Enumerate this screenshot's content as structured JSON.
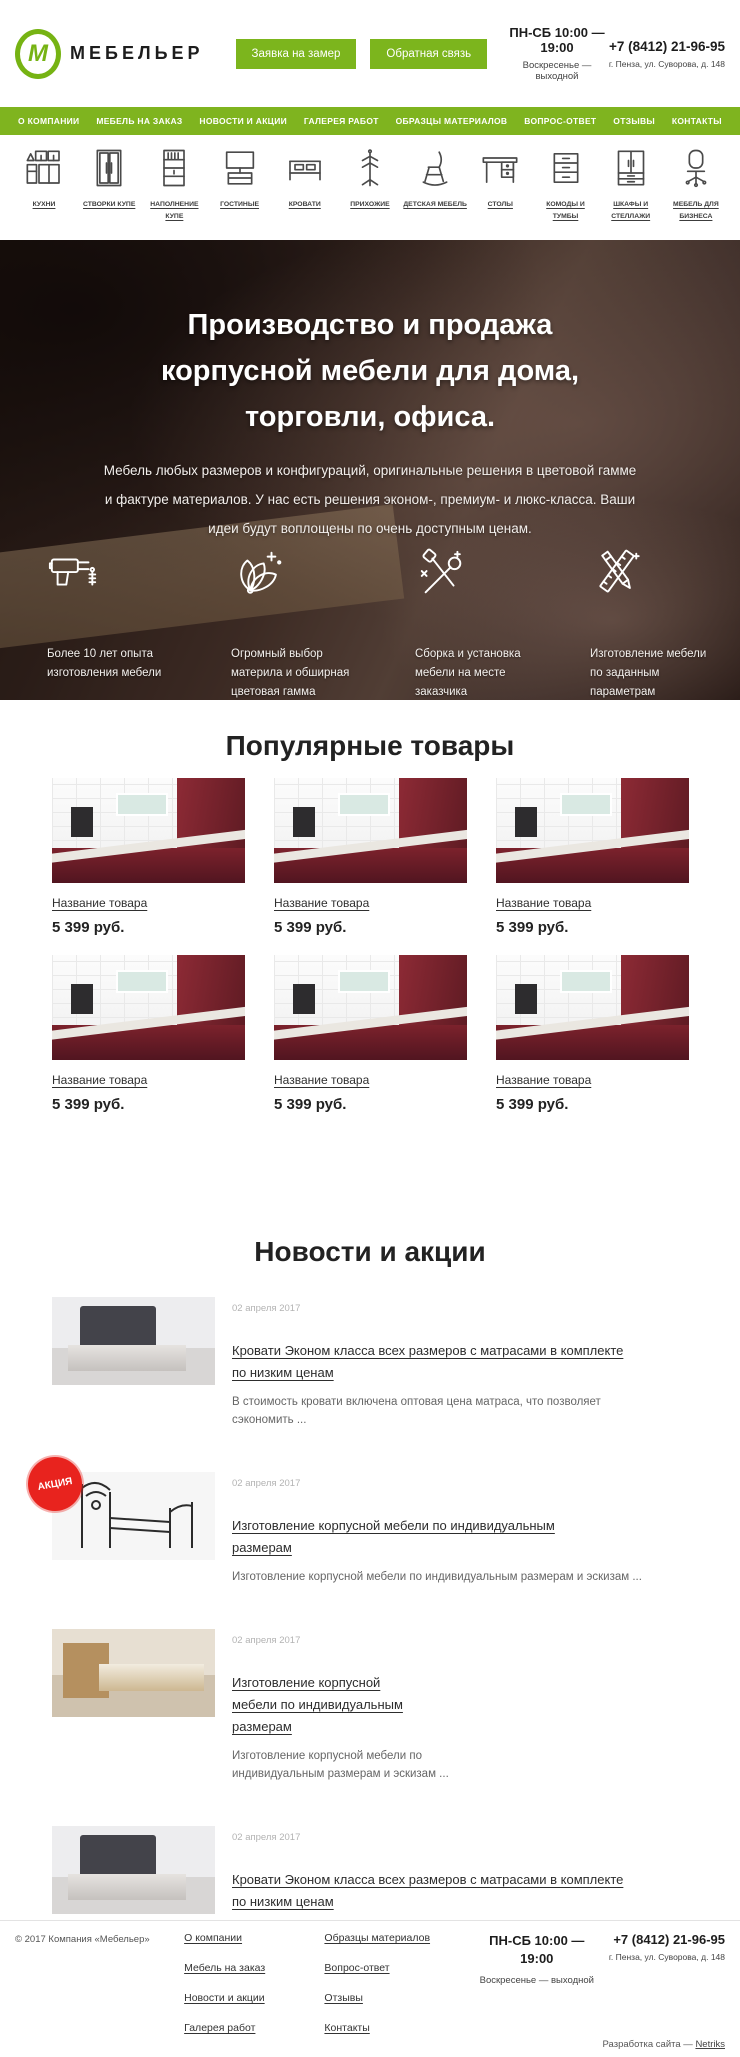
{
  "header": {
    "logo_letter": "М",
    "brand": "МЕБЕЛЬЕР",
    "request_button": "Заявка на замер",
    "feedback_button": "Обратная связь",
    "hours_main": "ПН-СБ 10:00 — 19:00",
    "hours_note": "Воскресенье — выходной",
    "phone": "+7 (8412) 21-96-95",
    "address": "г. Пенза, ул. Суворова, д. 148"
  },
  "nav": {
    "items": [
      "О КОМПАНИИ",
      "МЕБЕЛЬ НА ЗАКАЗ",
      "НОВОСТИ И АКЦИИ",
      "ГАЛЕРЕЯ РАБОТ",
      "ОБРАЗЦЫ МАТЕРИАЛОВ",
      "ВОПРОС-ОТВЕТ",
      "ОТЗЫВЫ",
      "КОНТАКТЫ"
    ]
  },
  "categories": {
    "items": [
      {
        "label": "КУХНИ",
        "icon": "kitchen-icon"
      },
      {
        "label": "СТВОРКИ КУПЕ",
        "icon": "sliding-doors-icon"
      },
      {
        "label": "НАПОЛНЕНИЕ КУПЕ",
        "icon": "shelving-icon"
      },
      {
        "label": "ГОСТИНЫЕ",
        "icon": "tv-stand-icon"
      },
      {
        "label": "КРОВАТИ",
        "icon": "bed-icon"
      },
      {
        "label": "ПРИХОЖИЕ",
        "icon": "coat-rack-icon"
      },
      {
        "label": "ДЕТСКАЯ МЕБЕЛЬ",
        "icon": "kids-chair-icon"
      },
      {
        "label": "СТОЛЫ",
        "icon": "desk-icon"
      },
      {
        "label": "КОМОДЫ И ТУМБЫ",
        "icon": "drawers-icon"
      },
      {
        "label": "ШКАФЫ И СТЕЛЛАЖИ",
        "icon": "wardrobe-icon"
      },
      {
        "label": "МЕБЕЛЬ ДЛЯ БИЗНЕСА",
        "icon": "office-chair-icon"
      }
    ]
  },
  "hero": {
    "title_lines": [
      "Производство и продажа",
      "корпусной мебели для дома,",
      "торговли, офиса."
    ],
    "subtitle": "Мебель любых размеров и конфигураций, оригинальные решения в цветовой гамме и фактуре материалов. У нас есть решения эконом-, премиум- и люкс-класса. Ваши идеи будут воплощены по очень доступным ценам.",
    "features": [
      {
        "icon": "drill-icon",
        "text": "Более 10 лет опыта изготовления мебели"
      },
      {
        "icon": "color-palette-icon",
        "text": "Огромный выбор материла и обширная цветовая гамма"
      },
      {
        "icon": "tools-icon",
        "text": "Сборка и установка мебели на месте заказчика"
      },
      {
        "icon": "drafting-tools-icon",
        "text": "Изготовление мебели по заданным параметрам"
      }
    ]
  },
  "popular": {
    "title": "Популярные товары",
    "products": [
      {
        "name": "Название товара",
        "price": "5 399 руб."
      },
      {
        "name": "Название товара",
        "price": "5 399 руб."
      },
      {
        "name": "Название товара",
        "price": "5 399 руб."
      },
      {
        "name": "Название товара",
        "price": "5 399 руб."
      },
      {
        "name": "Название товара",
        "price": "5 399 руб."
      },
      {
        "name": "Название товара",
        "price": "5 399 руб."
      }
    ]
  },
  "news": {
    "title": "Новости и акции",
    "items": [
      {
        "date": "02 апреля 2017",
        "title": "Кровати Эконом класса всех размеров с матрасами в комплекте по низким ценам",
        "text": "В стоимость кровати включена оптовая цена матраса, что позволяет сэкономить ...",
        "badge": ""
      },
      {
        "date": "02 апреля 2017",
        "title": "Изготовление корпусной мебели по индивидуальным размерам",
        "text": "Изготовление корпусной мебели по индивидуальным размерам и эскизам ...",
        "badge": "АКЦИЯ"
      },
      {
        "date": "02 апреля 2017",
        "title": "Изготовление корпусной мебели по индивидуальным размерам",
        "text": "Изготовление корпусной мебели по индивидуальным размерам и эскизам ...",
        "badge": ""
      },
      {
        "date": "02 апреля 2017",
        "title": "Кровати Эконом класса всех размеров с матрасами в комплекте по низким ценам",
        "text": "В стоимость кровати включена оптовая цена матраса, что позволяет сэкономить ...",
        "badge": ""
      }
    ]
  },
  "footer": {
    "copyright": "© 2017 Компания «Мебельер»",
    "col1": [
      "О компании",
      "Мебель на заказ",
      "Новости и акции",
      "Галерея работ"
    ],
    "col2": [
      "Образцы материалов",
      "Вопрос-ответ",
      "Отзывы",
      "Контакты"
    ],
    "hours_main": "ПН-СБ 10:00 — 19:00",
    "hours_note": "Воскресенье — выходной",
    "phone": "+7 (8412) 21-96-95",
    "address": "г. Пенза, ул. Суворова, д. 148",
    "credits_prefix": "Разработка сайта — ",
    "credits_link": "Netriks"
  },
  "colors": {
    "accent_green": "#7cb51d",
    "nav_green": "#7fb41f",
    "badge_red": "#e8231e",
    "kitchen_red": "#7c222c"
  }
}
